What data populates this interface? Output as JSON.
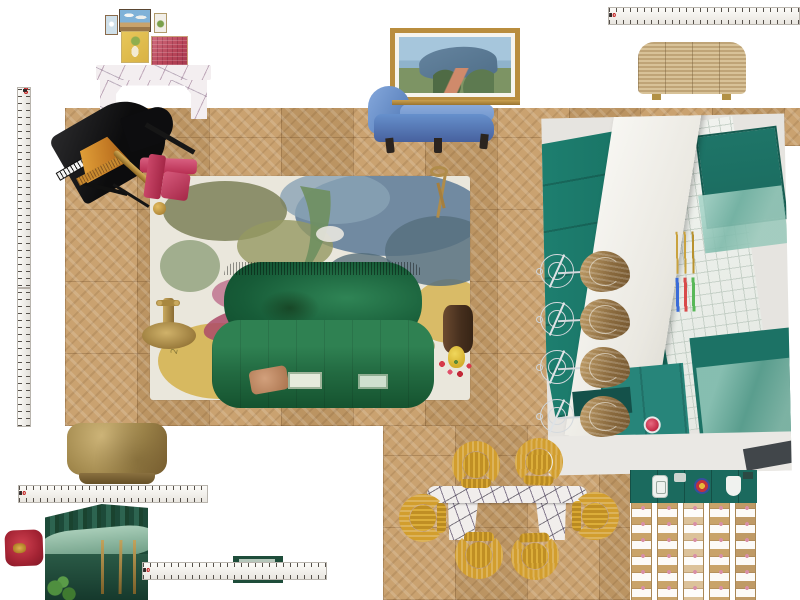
{
  "canvas": {
    "background": "#ffffff",
    "width": 800,
    "height": 600,
    "description": "Interior design mood board canvas with furniture cut-out images"
  },
  "rulers": {
    "tape_color": "#f7f5f1",
    "tick_color": "#55504a",
    "number_color": "#2c2c2c",
    "decade_number_color": "#c32222",
    "horizontal_sequence": [
      1,
      2,
      3,
      4,
      5,
      6,
      7,
      8,
      9,
      10,
      1,
      2,
      3,
      4,
      5,
      6,
      7,
      8,
      9,
      20,
      1,
      2,
      3,
      4,
      5,
      6,
      7,
      8
    ],
    "vertical_sequence": [
      8,
      7,
      6,
      5,
      4,
      3,
      2,
      20,
      9,
      8,
      7,
      6,
      5,
      4,
      3,
      2,
      1,
      10,
      9,
      8,
      7,
      6,
      5,
      4,
      3,
      2,
      1,
      20,
      9,
      8,
      7,
      6,
      5,
      4,
      3,
      2,
      1,
      10,
      9,
      8,
      7,
      6,
      5,
      4,
      3,
      2,
      1
    ]
  },
  "rug": {
    "signature": "2016",
    "colors": [
      "#eae7dc",
      "#64809a",
      "#7c8058",
      "#d4b04a",
      "#c27a93",
      "#ad4a68"
    ]
  },
  "palette": {
    "floor_oak": "#c79d68",
    "sofa_emerald": "#1f6b40",
    "kitchen_teal": "#1b7e6e",
    "chair_mustard": "#d29e2e",
    "chaise_blue": "#5d87c6",
    "cushion_crimson": "#b5273a",
    "brass_gold": "#9c8148",
    "marble_viola": "#8a5d7d"
  },
  "items": [
    {
      "name": "parquet-floor",
      "label": "Chevron parquet oak flooring panels"
    },
    {
      "name": "measuring-tape-top",
      "label": "Measuring tape, horizontal, top right"
    },
    {
      "name": "measuring-tape-left",
      "label": "Measuring tape, vertical, left edge"
    },
    {
      "name": "measuring-tape-ottoman",
      "label": "Measuring tape under brass ottoman"
    },
    {
      "name": "measuring-tape-bottom",
      "label": "Measuring tape, bottom centre"
    },
    {
      "name": "gallery-frame-blue-floral",
      "label": "Small framed floral print"
    },
    {
      "name": "gallery-frame-sky",
      "label": "Framed sky landscape print"
    },
    {
      "name": "gallery-frame-pear",
      "label": "Framed pear still life"
    },
    {
      "name": "gallery-frame-yellow",
      "label": "Framed yellow figure print"
    },
    {
      "name": "gallery-frame-red",
      "label": "Framed red abstract print"
    },
    {
      "name": "marble-console-table",
      "label": "Viola marble console table"
    },
    {
      "name": "grand-piano",
      "label": "Black grand piano, angled view"
    },
    {
      "name": "fringe-table-lamp",
      "label": "Amber fringed table lamp"
    },
    {
      "name": "accent-armchair-pink",
      "label": "Magenta velvet armchair, rotated"
    },
    {
      "name": "abstract-floral-rug",
      "label": "Abstract botanical rug, top view"
    },
    {
      "name": "green-velvet-sofa",
      "label": "Emerald green velvet sofa, top view"
    },
    {
      "name": "brass-side-table",
      "label": "Brass pedestal side table, top view"
    },
    {
      "name": "brass-floor-lamp",
      "label": "Brass floor lamp, top view"
    },
    {
      "name": "timber-drum-table",
      "label": "Timber drum side table with red flowers in yellow vase"
    },
    {
      "name": "landscape-painting",
      "label": "Gold-framed coastal landscape painting"
    },
    {
      "name": "blue-chaise",
      "label": "Blue velvet chaise lounge"
    },
    {
      "name": "rattan-sideboard",
      "label": "Rattan waterfall sideboard with brass feet"
    },
    {
      "name": "kitchen-photo",
      "label": "Teal kitchen renovation photo, rotated"
    },
    {
      "name": "counter-stools",
      "label": "Four wire-frame counter stools with woven seats"
    },
    {
      "name": "marble-dining-table",
      "label": "Viola marble dining table"
    },
    {
      "name": "dining-chairs-gold",
      "label": "Six mustard velvet tub dining chairs"
    },
    {
      "name": "brass-ottoman",
      "label": "Brass cube ottoman / coffee table"
    },
    {
      "name": "red-velvet-cushion",
      "label": "Crimson velvet cushion with gold crest"
    },
    {
      "name": "green-banquette-photo",
      "label": "Emerald green banquette photo with brass legs"
    },
    {
      "name": "green-fabric-swatch",
      "label": "Dark green swatch with label text"
    },
    {
      "name": "kitchen-floor-plan",
      "label": "Teal kitchen plan strip with sink, stove and round rug"
    },
    {
      "name": "bedroom-floor-plan",
      "label": "Rendered floor plan with rows of beds"
    }
  ]
}
